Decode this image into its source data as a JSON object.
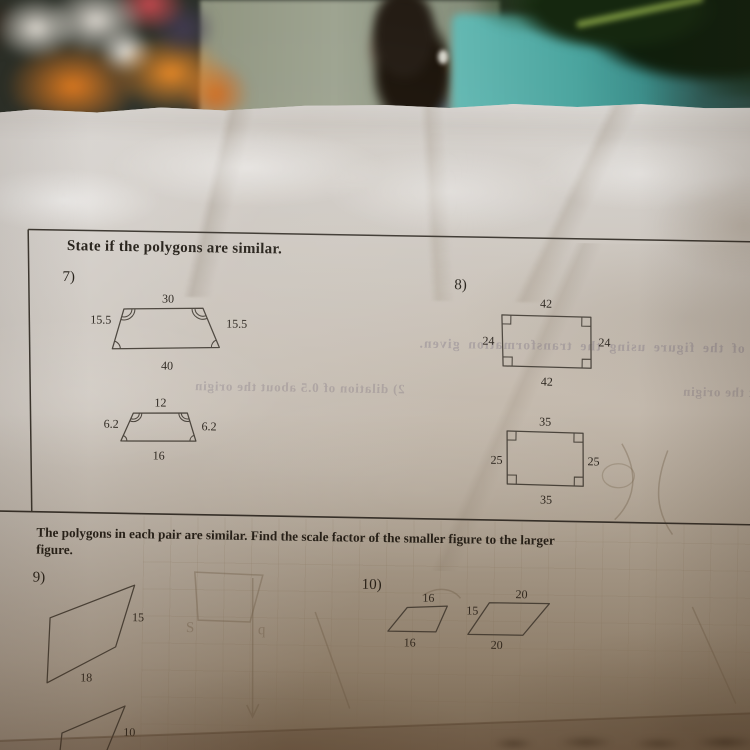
{
  "scene": {
    "snack_bag": "orange snack bag",
    "bottle": "dark bottle",
    "plant_pot": "teal plant pot",
    "plant": "green plant leaves"
  },
  "s1": {
    "heading": "State if the polygons are similar.",
    "p7": {
      "num": "7)",
      "big": {
        "top": "30",
        "left": "15.5",
        "right": "15.5",
        "bottom": "40"
      },
      "small": {
        "top": "12",
        "left": "6.2",
        "right": "6.2",
        "bottom": "16"
      }
    },
    "p8": {
      "num": "8)",
      "big": {
        "top": "42",
        "left": "24",
        "right": "24",
        "bottom": "42"
      },
      "small": {
        "top": "35",
        "left": "25",
        "right": "25",
        "bottom": "35"
      }
    }
  },
  "s2": {
    "heading_line1": "The polygons in each pair are similar.  Find the scale factor of the smaller figure to the larger",
    "heading_line2": "figure.",
    "p9": {
      "num": "9)",
      "big": {
        "right": "15",
        "bottom": "18"
      },
      "small": {
        "right": "10"
      }
    },
    "p10": {
      "num": "10)",
      "small": {
        "top": "16",
        "bottom": "16"
      },
      "big": {
        "top": "20",
        "left": "15",
        "bottom": "20"
      }
    }
  },
  "bleed": {
    "line1": "e of the figure using the transformation given.",
    "line2": "2) dilation of 0.5 about the origin",
    "line3": "bout the origin",
    "mark_s": "S",
    "mark_q": "q"
  }
}
